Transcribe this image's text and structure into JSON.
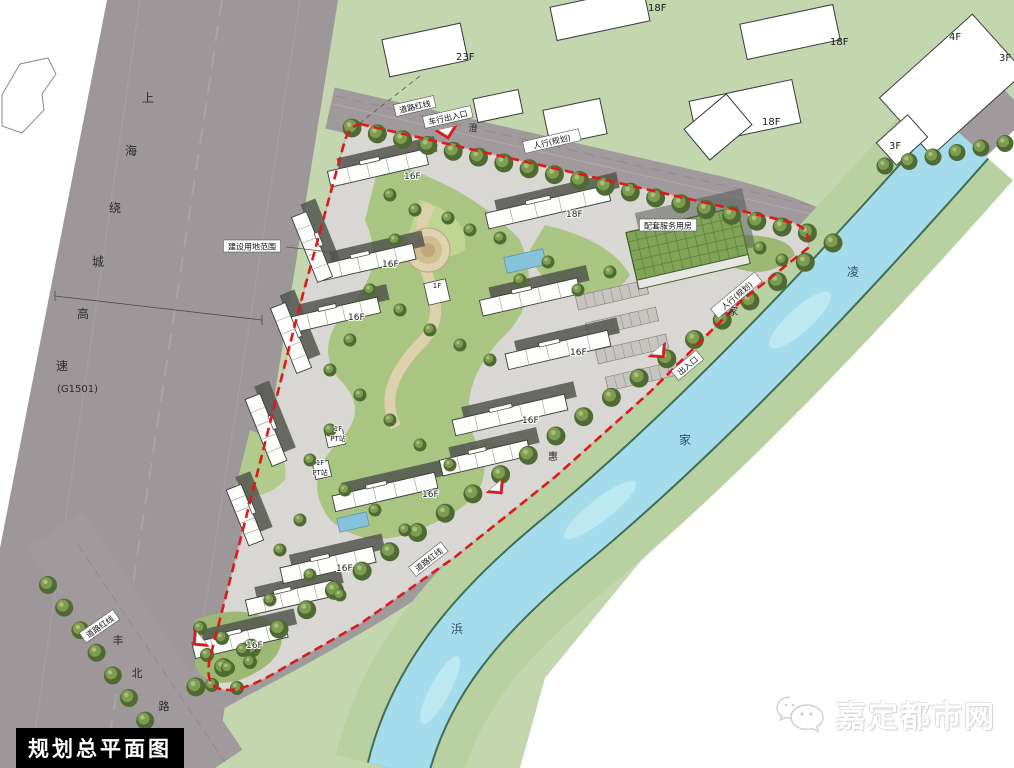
{
  "title_box": {
    "label": "规划总平面图"
  },
  "watermark": {
    "label": "嘉定都市网",
    "icon": "chat-bubbles-icon"
  },
  "colors": {
    "boundary_red": "#dd1a1a",
    "water": "#a5dcec",
    "green_field": "#c3d6ad",
    "road_gray": "#9d9799",
    "site_paving": "#d9d7d3",
    "roof_green": "#7fa457",
    "tree_dark": "#4f6b33",
    "tree_light": "#7d9c52"
  },
  "map": {
    "roads": {
      "g1501": {
        "name": "上海绕城高速",
        "code": "(G1501)",
        "name_chars": [
          {
            "t": "上",
            "x": 148,
            "y": 102
          },
          {
            "t": "海",
            "x": 131,
            "y": 155
          },
          {
            "t": "绕",
            "x": 115,
            "y": 212
          },
          {
            "t": "城",
            "x": 98,
            "y": 266
          },
          {
            "t": "高",
            "x": 83,
            "y": 318
          },
          {
            "t": "速",
            "x": 62,
            "y": 370
          }
        ],
        "code_pos": {
          "x": 57,
          "y": 392
        }
      },
      "fengbei": {
        "name": "丰北路",
        "chars": [
          {
            "t": "丰",
            "x": 118,
            "y": 644
          },
          {
            "t": "北",
            "x": 137,
            "y": 677
          },
          {
            "t": "路",
            "x": 164,
            "y": 710
          }
        ]
      },
      "north_road": {
        "chars": [
          {
            "t": "澄",
            "x": 473,
            "y": 131
          }
        ]
      },
      "river_road": {
        "chars": [
          {
            "t": "家",
            "x": 733,
            "y": 315
          },
          {
            "t": "惠",
            "x": 553,
            "y": 460
          }
        ]
      }
    },
    "river": {
      "name": "凌家浜",
      "chars": [
        {
          "t": "凌",
          "x": 853,
          "y": 276
        },
        {
          "t": "家",
          "x": 685,
          "y": 444
        },
        {
          "t": "浜",
          "x": 457,
          "y": 633
        }
      ]
    },
    "annotations": [
      {
        "t": "道路红线",
        "x": 415,
        "y": 107,
        "r": -13
      },
      {
        "t": "道路红线",
        "x": 100,
        "y": 627,
        "r": -35
      },
      {
        "t": "道路红线",
        "x": 429,
        "y": 560,
        "r": -38
      },
      {
        "t": "建设用地范围",
        "x": 252,
        "y": 247,
        "r": 0
      },
      {
        "t": "配套服务用房",
        "x": 668,
        "y": 226,
        "r": 0
      },
      {
        "t": "车行出入口",
        "x": 448,
        "y": 118,
        "r": -13
      },
      {
        "t": "人行(规划)",
        "x": 552,
        "y": 142,
        "r": -13
      },
      {
        "t": "人行(规划)",
        "x": 737,
        "y": 296,
        "r": -40
      },
      {
        "t": "出入口",
        "x": 688,
        "y": 366,
        "r": -40
      }
    ],
    "outside_building_labels": [
      {
        "t": "23F",
        "x": 456,
        "y": 60
      },
      {
        "t": "18F",
        "x": 648,
        "y": 11
      },
      {
        "t": "18F",
        "x": 830,
        "y": 45
      },
      {
        "t": "18F",
        "x": 762,
        "y": 125
      },
      {
        "t": "4F",
        "x": 949,
        "y": 40
      },
      {
        "t": "3F",
        "x": 999,
        "y": 61
      },
      {
        "t": "3F",
        "x": 889,
        "y": 149
      }
    ],
    "site_buildings": [
      {
        "x": 378,
        "y": 168,
        "len": 100,
        "rot": -13,
        "label": "16F",
        "lx": 404,
        "ly": 179
      },
      {
        "x": 548,
        "y": 207,
        "len": 125,
        "rot": -13,
        "label": "18F",
        "lx": 566,
        "ly": 217
      },
      {
        "x": 368,
        "y": 262,
        "len": 95,
        "rot": -13,
        "label": "16F",
        "lx": 382,
        "ly": 267
      },
      {
        "x": 335,
        "y": 315,
        "len": 90,
        "rot": -13,
        "label": "16F",
        "lx": 348,
        "ly": 320
      },
      {
        "x": 530,
        "y": 297,
        "len": 100,
        "rot": -13,
        "label": "",
        "lx": 0,
        "ly": 0
      },
      {
        "x": 558,
        "y": 350,
        "len": 105,
        "rot": -13,
        "label": "16F",
        "lx": 570,
        "ly": 355
      },
      {
        "x": 510,
        "y": 415,
        "len": 115,
        "rot": -13,
        "label": "16F",
        "lx": 522,
        "ly": 423
      },
      {
        "x": 485,
        "y": 458,
        "len": 90,
        "rot": -13,
        "label": "",
        "lx": 0,
        "ly": 0
      },
      {
        "x": 385,
        "y": 492,
        "len": 105,
        "rot": -13,
        "label": "16F",
        "lx": 422,
        "ly": 497
      },
      {
        "x": 328,
        "y": 565,
        "len": 95,
        "rot": -13,
        "label": "16F",
        "lx": 336,
        "ly": 571
      },
      {
        "x": 290,
        "y": 598,
        "len": 88,
        "rot": -13,
        "label": "",
        "lx": 0,
        "ly": 0
      },
      {
        "x": 240,
        "y": 640,
        "len": 95,
        "rot": -13,
        "label": "16F",
        "lx": 246,
        "ly": 648
      },
      {
        "x": 312,
        "y": 247,
        "len": 70,
        "rot": 68,
        "label": "",
        "lx": 0,
        "ly": 0
      },
      {
        "x": 291,
        "y": 338,
        "len": 70,
        "rot": 68,
        "label": "",
        "lx": 0,
        "ly": 0
      },
      {
        "x": 266,
        "y": 430,
        "len": 72,
        "rot": 68,
        "label": "",
        "lx": 0,
        "ly": 0
      },
      {
        "x": 245,
        "y": 515,
        "len": 60,
        "rot": 68,
        "label": "",
        "lx": 0,
        "ly": 0
      }
    ],
    "amenity_buildings": [
      {
        "x": 437,
        "y": 292,
        "s": 22
      },
      {
        "x": 335,
        "y": 437,
        "s": 18
      },
      {
        "x": 322,
        "y": 470,
        "s": 16
      }
    ],
    "small_labels": [
      {
        "t": "1F",
        "x": 437,
        "y": 288
      },
      {
        "t": "1F",
        "x": 338,
        "y": 431
      },
      {
        "t": "PT站",
        "x": 338,
        "y": 441
      },
      {
        "t": "1F",
        "x": 320,
        "y": 465
      },
      {
        "t": "PT站",
        "x": 320,
        "y": 475
      }
    ]
  }
}
